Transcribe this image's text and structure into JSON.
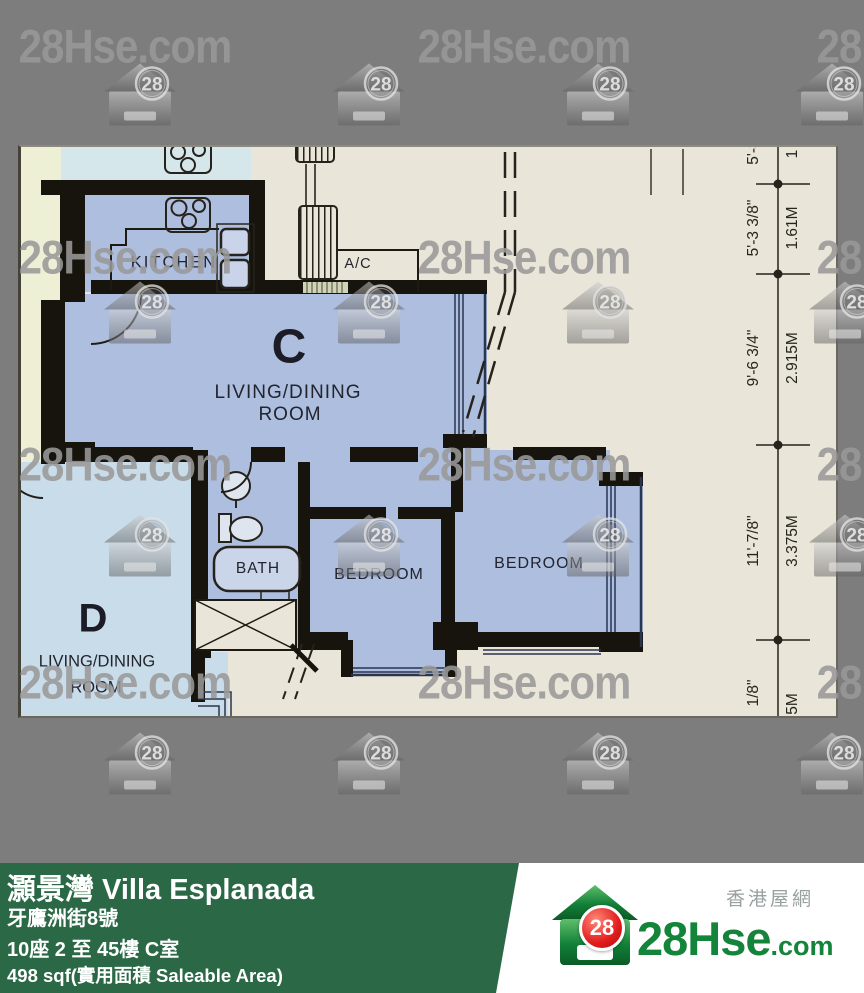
{
  "watermarks": {
    "text": "28Hse.com",
    "badge": "28",
    "text_positions": [
      [
        125,
        47
      ],
      [
        524,
        47
      ],
      [
        923,
        47
      ],
      [
        125,
        258
      ],
      [
        524,
        258
      ],
      [
        923,
        258
      ],
      [
        125,
        465
      ],
      [
        524,
        465
      ],
      [
        923,
        465
      ],
      [
        125,
        683
      ],
      [
        524,
        683
      ],
      [
        923,
        683
      ]
    ],
    "logo_positions": [
      [
        140,
        97
      ],
      [
        369,
        97
      ],
      [
        598,
        97
      ],
      [
        832,
        97
      ],
      [
        140,
        315
      ],
      [
        369,
        315
      ],
      [
        598,
        315
      ],
      [
        845,
        315
      ],
      [
        140,
        548
      ],
      [
        369,
        548
      ],
      [
        598,
        548
      ],
      [
        845,
        548
      ],
      [
        140,
        766
      ],
      [
        369,
        766
      ],
      [
        598,
        766
      ],
      [
        832,
        766
      ]
    ]
  },
  "floorplan": {
    "unit_c_label": "C",
    "living_dining_line1": "LIVING/DINING",
    "living_dining_line2": "ROOM",
    "kitchen_label": "KITCHEN",
    "ac_label": "A/C",
    "bath_label": "BATH",
    "bedroom1_label": "BEDROOM",
    "bedroom2_label": "BEDROOM",
    "unit_d_label": "D",
    "unit_d_line1": "LIVING/DINING",
    "unit_d_line2": "ROOM"
  },
  "dimensions": {
    "segments": [
      {
        "imperial": "5'-3",
        "metric": "1"
      },
      {
        "imperial": "5'-3 3/8\"",
        "metric": "1.61M"
      },
      {
        "imperial": "9'-6 3/4\"",
        "metric": "2.915M"
      },
      {
        "imperial": "11'-7/8\"",
        "metric": "3.375M"
      },
      {
        "imperial": "1/8\"",
        "metric": "5M"
      }
    ]
  },
  "footer": {
    "building_name": "灝景灣 Villa Esplanada",
    "address": "牙鷹洲街8號",
    "block_floor_flat": "10座 2 至 45樓 C室",
    "area": "498 sqf(實用面積 Saleable Area)",
    "brand": {
      "cn": "香港屋網",
      "logo_text": "28Hse",
      "logo_suffix": ".com",
      "badge": "28"
    }
  },
  "colors": {
    "background_gray": "#7d7d7d",
    "plan_cream": "#e9e5d8",
    "unit_c_blue": "#adbedf",
    "unit_d_blue": "#c8dcea",
    "adjacent_cyan": "#d6e7ec",
    "pale_strip": "#eef0d6",
    "wall_black": "#17130d",
    "footer_green": "#2b6946",
    "logo_green": "#15843b",
    "badge_red": "#e21b1b"
  }
}
